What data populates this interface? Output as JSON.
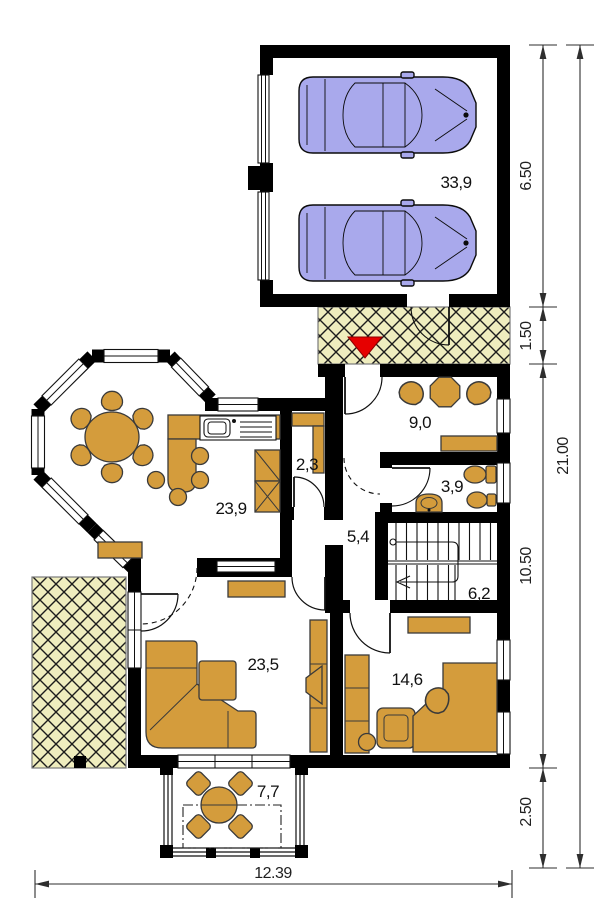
{
  "floor_plan": {
    "room_labels": {
      "garage": "33,9",
      "vestibule": "9,0",
      "pantry": "2,3",
      "bathroom": "3,9",
      "kitchen_dining": "23,9",
      "hall": "5,4",
      "staircase": "6,2",
      "living_room": "23,5",
      "bedroom": "14,6",
      "terrace": "7,7"
    },
    "dimensions": {
      "garage_depth": "6.50",
      "entry_strip_depth": "1.50",
      "house_depth": "10.50",
      "terrace_depth": "2.50",
      "total_depth": "21.00",
      "total_width": "12.39"
    },
    "icons": {
      "entrance_arrow": "red triangle pointing down (main entrance)"
    },
    "colors": {
      "walls": "#000000",
      "furniture": "#D49C3C",
      "cars": "#A9A9EC",
      "paving_hatch": "#EFEDBE",
      "entrance_arrow": "#E60000",
      "dimension_lines": "#2E2E2E"
    }
  }
}
